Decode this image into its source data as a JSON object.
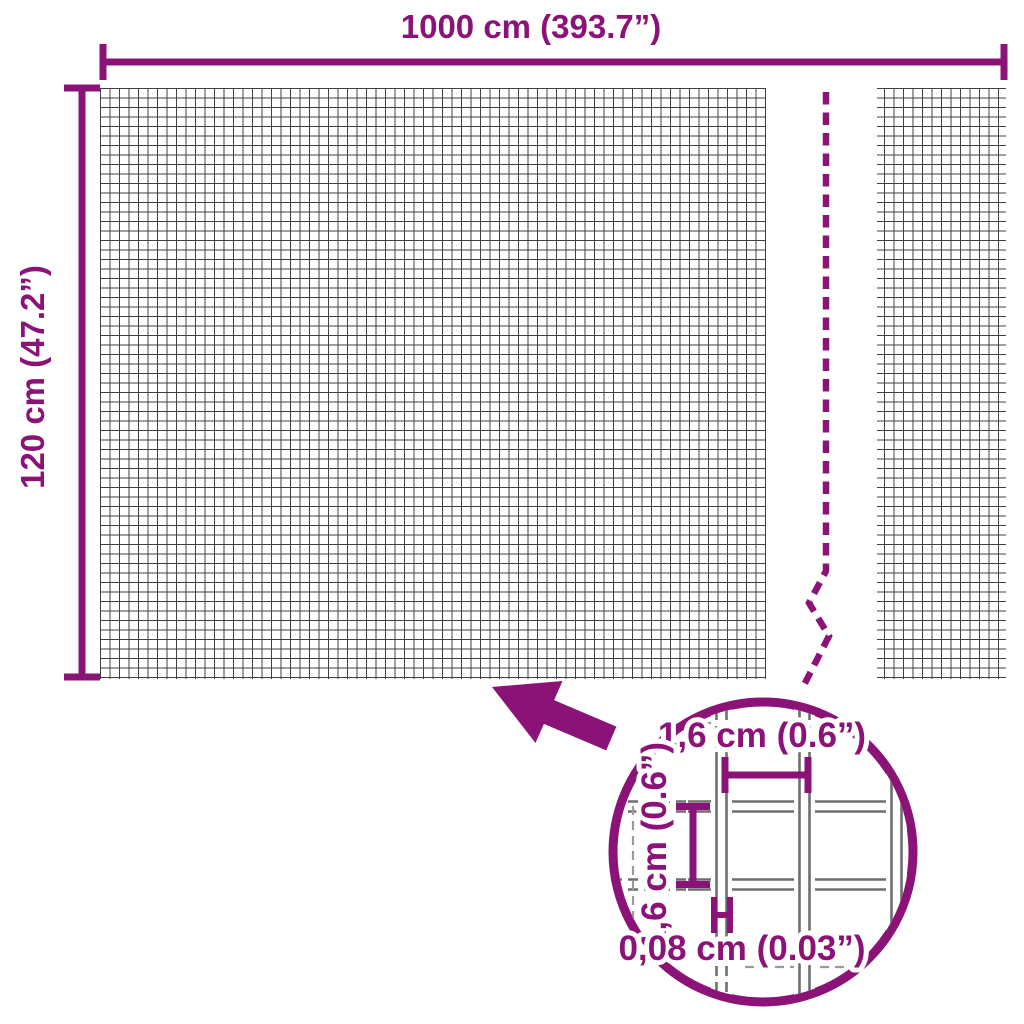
{
  "colors": {
    "accent": "#8B1378",
    "mesh-line": "#3f3f3f",
    "wire-line": "#6e6e6e",
    "guide-line": "#9a9a9a"
  },
  "product_diagram": {
    "type": "mesh-fence-roll-dimension-diagram",
    "overall_width_label": "1000 cm (393.7”)",
    "overall_height_label": "120 cm (47.2”)",
    "detail": {
      "mesh_pitch_horizontal_label": "1,6 cm (0.6”)",
      "mesh_pitch_vertical_label": "1,6 cm (0.6”)",
      "wire_thickness_label": "0,08 cm (0.03”)"
    }
  }
}
